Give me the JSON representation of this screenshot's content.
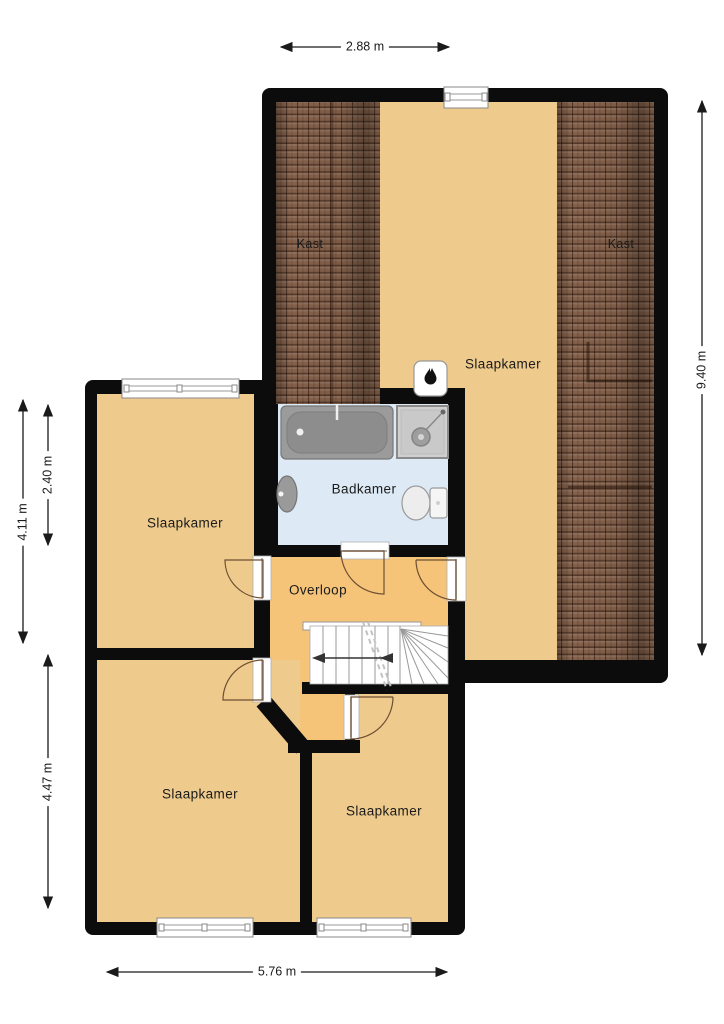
{
  "labels": {
    "kast_left": "Kast",
    "kast_right": "Kast",
    "slaapkamer_attic": "Slaapkamer",
    "badkamer": "Badkamer",
    "slaapkamer_left": "Slaapkamer",
    "overloop": "Overloop",
    "slaapkamer_bottom_left": "Slaapkamer",
    "slaapkamer_bottom_right": "Slaapkamer"
  },
  "dimensions": {
    "top": "2.88 m",
    "right": "9.40 m",
    "left_upper": "4.11 m",
    "left_inner": "2.40 m",
    "left_lower": "4.47 m",
    "bottom": "5.76 m"
  },
  "colors": {
    "wall": "#0c0c0c",
    "bedroom_floor": "#eeca8c",
    "landing_floor": "#f6c478",
    "bathroom_floor": "#dde9f5",
    "roof_tile": "#83604a",
    "background": "#ffffff"
  }
}
